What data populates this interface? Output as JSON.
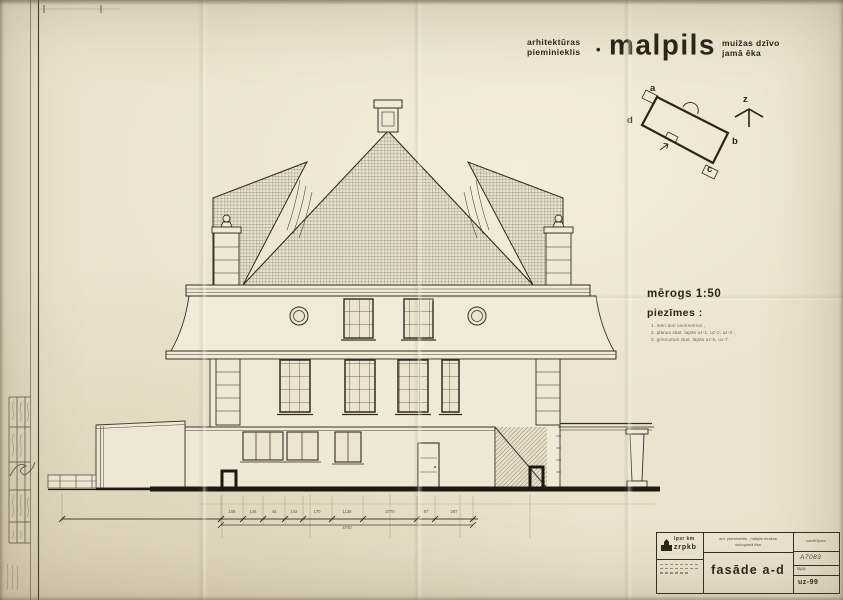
{
  "colors": {
    "paper": "#ebe3cd",
    "ink": "#332d22",
    "ink_light": "#6e6454"
  },
  "header": {
    "pretitle_line1": "arhitektūras",
    "pretitle_line2": "pieminieklis",
    "bullet": "•",
    "title": "malpils",
    "subtitle_line1": "muižas dzīvo",
    "subtitle_line2": "jamā ēka"
  },
  "site_plan": {
    "corner_a": "a",
    "corner_b": "b",
    "corner_c": "c",
    "corner_d": "d",
    "north_label": "z"
  },
  "scale_label": "mērogs 1:50",
  "notes": {
    "heading": "piezīmes :",
    "items": [
      "1. mēri doti centimetros ,",
      "2. plānus skat. lapās uz-1, uz-2, uz-3 ,",
      "3. griezumus skat. lapās uz-6, uz-7 ."
    ]
  },
  "dimensions": {
    "segments": [
      "108",
      "146",
      "44",
      "142",
      "170",
      "1138",
      "2770",
      "97",
      "287"
    ],
    "total": "4740"
  },
  "title_block": {
    "org_line1": "lpsr km",
    "org_line2": "zrpkb",
    "object_line1": "arh. piemineklis - mālpils muižas",
    "object_line2": "dzīvojamā ēka",
    "drawing_title": "fasāde a-d",
    "doc_type": "uzmērījums",
    "doc_number": "A7083",
    "sheet_label": "lapa",
    "sheet_number": "uz-99"
  }
}
